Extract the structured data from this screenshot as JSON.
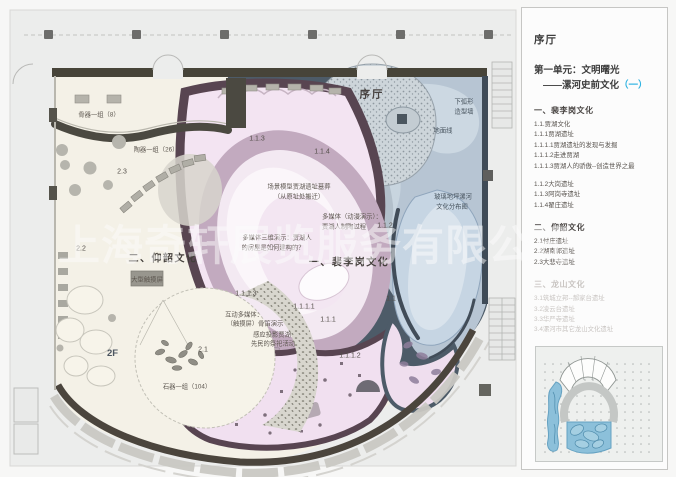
{
  "panel": {
    "hall_title": "序厅",
    "unit_title_line1": "第一单元：文明曙光",
    "unit_title_line2": "——漯河史前文化",
    "unit_title_accent": "（一）",
    "accent_color": "#2fb3e2",
    "sections": [
      {
        "heading": "一、裴李岗文化",
        "muted": false,
        "items": [
          "1.1.贾湖文化",
          "1.1.1贾湖遗址",
          "1.1.1.1贾湖遗址的发现与发掘",
          "1.1.1.2走进贾湖",
          "1.1.1.3贾湖人的骄傲--创造世界之最",
          "",
          "1.1.2大岗遗址",
          "1.1.3阿岗寺遗址",
          "1.1.4翟庄遗址"
        ]
      },
      {
        "heading": "二、仰韶文化",
        "muted": false,
        "items": [
          "2.1付庄遗址",
          "2.2湖南郭遗址",
          "2.3大悲寺遗址"
        ]
      },
      {
        "heading": "三、龙山文化",
        "muted": true,
        "items": [
          "3.1筑城立邦--郝家台遗址",
          "3.2凌云台遗址",
          "3.3华严寺遗址",
          "3.4漯河市其它龙山文化遗址"
        ]
      }
    ],
    "keyplan_label": "2F"
  },
  "plan": {
    "watermark": "上海奇轩展览服务有限公司",
    "labels": [
      {
        "name": "hall-title-plan",
        "cls": "pl-hall",
        "text": "序厅",
        "x": 372,
        "y": 94
      },
      {
        "name": "section-yangshao",
        "cls": "pl-section",
        "text": "二、仰韶文化",
        "x": 163,
        "y": 257
      },
      {
        "name": "section-peiligang",
        "cls": "pl-section",
        "text": "一、裴李岗文化",
        "x": 349,
        "y": 261
      },
      {
        "name": "label-bone-group",
        "cls": "pl-small",
        "text": "骨器一组（8）",
        "x": 99,
        "y": 114
      },
      {
        "name": "label-pottery-group",
        "cls": "pl-small",
        "text": "陶器一组（26）",
        "x": 156,
        "y": 149
      },
      {
        "name": "label-touch-screen",
        "cls": "pl-small",
        "text": "大型触摸屏",
        "x": 147,
        "y": 279
      },
      {
        "name": "label-stone-group",
        "cls": "pl-small",
        "text": "石器一组（104）",
        "x": 187,
        "y": 386
      },
      {
        "name": "label-scene-model-1",
        "cls": "pl-small",
        "text": "场景模型贾湖遗址墓葬",
        "x": 299,
        "y": 186
      },
      {
        "name": "label-scene-model-2",
        "cls": "pl-small",
        "text": "（从原址处搬迁）",
        "x": 299,
        "y": 196
      },
      {
        "name": "label-mm-anim-1",
        "cls": "pl-small",
        "text": "多媒体（动漫演示）：",
        "x": 352,
        "y": 216
      },
      {
        "name": "label-mm-anim-2",
        "cls": "pl-small",
        "text": "贾湖人制陶过程",
        "x": 344,
        "y": 226
      },
      {
        "name": "label-mm-3d-1",
        "cls": "pl-small",
        "text": "多媒体三维演示：贾湖人",
        "x": 277,
        "y": 237
      },
      {
        "name": "label-mm-3d-2",
        "cls": "pl-small",
        "text": "的房屋是如何建构的？",
        "x": 273,
        "y": 247
      },
      {
        "name": "label-mm-interactive-1",
        "cls": "pl-small",
        "text": "互动多媒体：",
        "x": 244,
        "y": 314
      },
      {
        "name": "label-mm-interactive-2",
        "cls": "pl-small",
        "text": "（触摸屏）骨笛演示",
        "x": 255,
        "y": 323
      },
      {
        "name": "label-projection-1",
        "cls": "pl-small",
        "text": "感应投影贾湖",
        "x": 272,
        "y": 334
      },
      {
        "name": "label-projection-2",
        "cls": "pl-small",
        "text": "先民的祭祀活动",
        "x": 273,
        "y": 343
      },
      {
        "name": "label-arc-wall-1",
        "cls": "pl-small-blue",
        "text": "下弧形",
        "x": 464,
        "y": 101
      },
      {
        "name": "label-arc-wall-2",
        "cls": "pl-small-blue",
        "text": "造型墙",
        "x": 464,
        "y": 111
      },
      {
        "name": "label-ground-line",
        "cls": "pl-small-blue",
        "text": "地面线",
        "x": 443,
        "y": 130
      },
      {
        "name": "label-glass-floor-1",
        "cls": "pl-small-blue",
        "text": "玻璃地坪漯河",
        "x": 453,
        "y": 196
      },
      {
        "name": "label-glass-floor-2",
        "cls": "pl-small-blue",
        "text": "文化分布图",
        "x": 452,
        "y": 206
      },
      {
        "name": "code-2-3",
        "cls": "pl-code",
        "text": "2.3",
        "x": 122,
        "y": 172
      },
      {
        "name": "code-2-2",
        "cls": "pl-code",
        "text": "2.2",
        "x": 81,
        "y": 249
      },
      {
        "name": "code-2-1",
        "cls": "pl-code",
        "text": "2.1",
        "x": 203,
        "y": 350
      },
      {
        "name": "code-1-1-3",
        "cls": "pl-code",
        "text": "1.1.3",
        "x": 257,
        "y": 139
      },
      {
        "name": "code-1-1-4",
        "cls": "pl-code",
        "text": "1.1.4",
        "x": 322,
        "y": 152
      },
      {
        "name": "code-1-1-2",
        "cls": "pl-code",
        "text": "1.1.2",
        "x": 385,
        "y": 226
      },
      {
        "name": "code-1-1",
        "cls": "pl-code",
        "text": "1.1",
        "x": 391,
        "y": 299
      },
      {
        "name": "code-1-1-1-1",
        "cls": "pl-code",
        "text": "1.1.1.1",
        "x": 304,
        "y": 307
      },
      {
        "name": "code-1-1-1",
        "cls": "pl-code",
        "text": "1.1.1",
        "x": 328,
        "y": 320
      },
      {
        "name": "code-1-1-1-3",
        "cls": "pl-code",
        "text": "1.1.1.3",
        "x": 246,
        "y": 294
      },
      {
        "name": "code-1-1-1-2",
        "cls": "pl-code",
        "text": "1.1.1.2",
        "x": 350,
        "y": 356
      }
    ]
  },
  "colors": {
    "accent_cyan": "#2fb3e2",
    "wall_dark": "#474439",
    "slate_background": "#4d5b68",
    "plum_partition": "#584551",
    "pink_zone": "#f3e4f2",
    "cream_zone": "#f4f1e7",
    "blue_zone": "#b7c5d3",
    "glass_floor": "#c6d5e3",
    "keyplan_blue": "#8cc0da"
  }
}
